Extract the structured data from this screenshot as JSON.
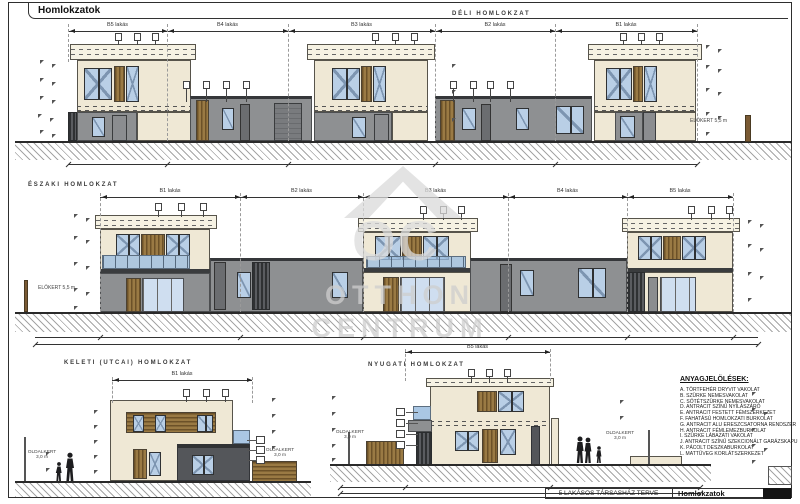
{
  "sheet": {
    "tab_title": "Homlokzatok"
  },
  "titleblock": {
    "project": "5 LAKÁSOS TÁRSASHÁZ TERVE",
    "sheet_name": "Homlokzatok"
  },
  "watermark": {
    "initials": "OC",
    "line1": "OTTHON",
    "line2": "CENTRUM"
  },
  "elevations": {
    "south": {
      "title": "DÉLI HOMLOKZAT",
      "units": [
        "B5 lakás",
        "B4 lakás",
        "B3 lakás",
        "B2 lakás",
        "B1 lakás"
      ],
      "front_yard_label": "ELŐKERT 5,5 m"
    },
    "north": {
      "title": "ÉSZAKI HOMLOKZAT",
      "units": [
        "B1 lakás",
        "B2 lakás",
        "B3 lakás",
        "B4 lakás",
        "B5 lakás"
      ],
      "front_yard_label": "ELŐKERT 5,5 m"
    },
    "east": {
      "title": "KELETI (UTCAI) HOMLOKZAT",
      "unit_label": "B1 lakás",
      "side_yard_left": "OLDALKERT 3,0 m",
      "side_yard_right": "OLDALKERT 3,0 m"
    },
    "west": {
      "title": "NYUGATI HOMLOKZAT",
      "unit_label": "B5 lakás",
      "side_yard_left": "OLDALKERT 3,0 m",
      "side_yard_right": "OLDALKERT 3,0 m"
    }
  },
  "legend": {
    "title": "ANYAGJELÖLÉSEK:",
    "items": [
      "A. TÖRTFEHÉR DRYVIT VAKOLAT",
      "B. SZÜRKE NEMESVAKOLAT",
      "C. SÖTÉTSZÜRKE NEMESVAKOLAT",
      "D. ANTRACIT SZÍNŰ NYÍLÁSZÁRÓ",
      "E. ANTRACIT FESTETT FÉMSZERKEZET",
      "F. FAHATÁSÚ HOMLOKZATI BURKOLAT",
      "G. ANTRACIT ALU ERESZCSATORNA RENDSZER",
      "H. ANTRACIT FÉMLEMEZBURKOLAT",
      "I. SZÜRKE LÁBAZATI VAKOLAT",
      "J. ANTRACIT SZÍNŰ SZEKCIONÁLT GARÁZSKAPU",
      "K. PÁCOLT DESZKABURKOLAT",
      "L. MATTÜVEG KORLÁTSZERKEZET"
    ]
  },
  "colors": {
    "cream_wall": "#efe8d5",
    "grey_wall": "#8e9092",
    "anthracite": "#54565a",
    "wood": "#8a6a3e",
    "glass": "#b9cfe6"
  }
}
